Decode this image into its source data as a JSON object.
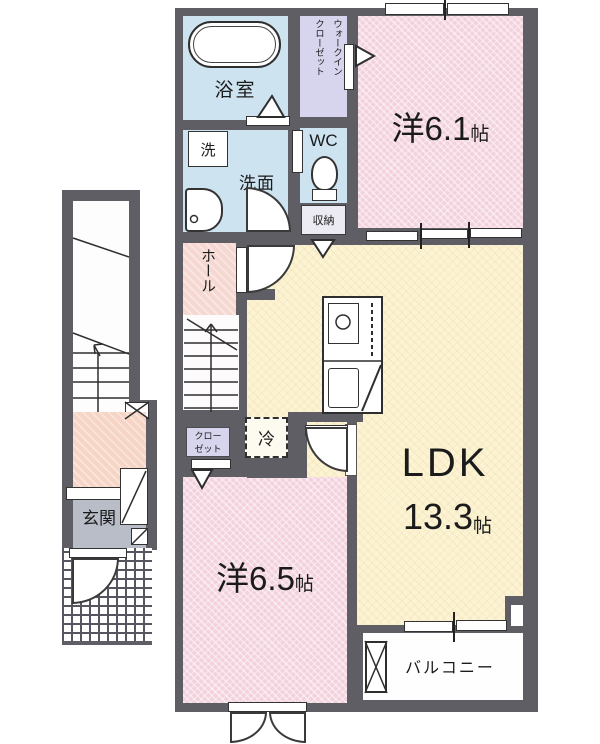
{
  "title": "2F apartment floor plan",
  "colors": {
    "wall": "#5e5e64",
    "room_pink": "#f3d2de",
    "ldk_cream": "#fbf3d2",
    "wet_area_blue": "#cde3f0",
    "closet_lavender": "#d7d5ed",
    "hall_peach": "#f6d8d2",
    "entrance_gray": "#b9bdc7"
  },
  "rooms": {
    "bathroom": {
      "label": "浴室"
    },
    "walkin_closet": {
      "line1": "ウォークイン",
      "line2": "クローゼット"
    },
    "western_6_1": {
      "name": "洋6.1",
      "unit": "帖"
    },
    "laundry": {
      "label": "洗"
    },
    "washroom": {
      "label": "洗面"
    },
    "wc": {
      "label": "WC"
    },
    "storage": {
      "label": "収納"
    },
    "hall": {
      "label": "ホール"
    },
    "closet": {
      "line1": "クロー",
      "line2": "ゼット"
    },
    "refrigerator": {
      "label": "冷"
    },
    "ldk": {
      "name": "LDK",
      "size": "13.3",
      "unit": "帖"
    },
    "western_6_5": {
      "name": "洋6.5",
      "unit": "帖"
    },
    "balcony": {
      "label": "バルコニー"
    },
    "entrance": {
      "label": "玄関"
    }
  }
}
